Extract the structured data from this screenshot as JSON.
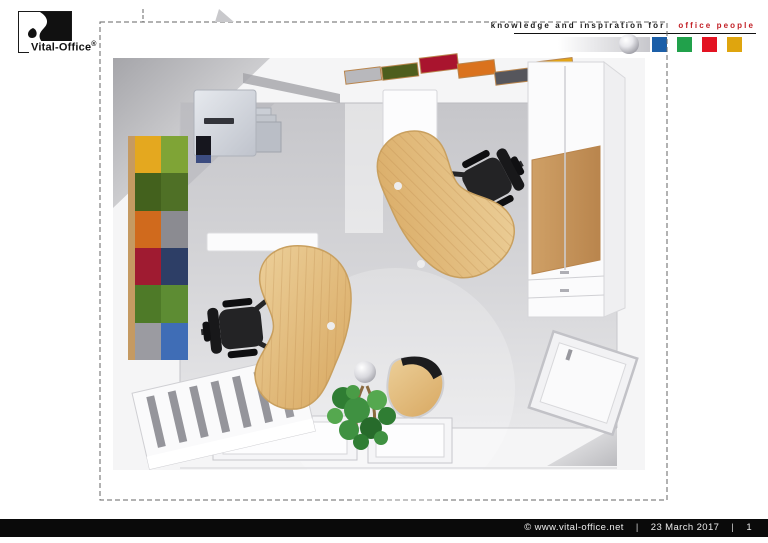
{
  "header": {
    "brand": "Vital-Office",
    "registered": "®",
    "tagline_black": "knowledge and inspiration for",
    "tagline_red": "office people",
    "tagline_red_color": "#c22026",
    "squares": [
      "#1c5fa8",
      "#21a14b",
      "#e31322",
      "#dfa50e"
    ]
  },
  "footer": {
    "copyright": "©  www.vital-office.net",
    "sep1": "|",
    "date": "23 March 2017",
    "sep2": "|",
    "page": "1"
  },
  "drawing": {
    "description": "3D top view rendering of an office room with two kidney-shaped beech desks, two black swivel chairs, colourful acoustic wall panel, ceiling panels, printer, tall cabinet, sideboard and plant",
    "floor_color": "#d2d2d5",
    "desk_wood_color": "#e0b872",
    "desk_edge_color": "#c9a05f",
    "chair_color": "#1c1c1e",
    "plant_color": "#3a8a3e",
    "panel_edge_color": "#c59a62",
    "ceiling_edge_color": "#b9854d",
    "wall_panel": {
      "cells": [
        "#e4a81f",
        "#7fa436",
        "#43611d",
        "#4f7026",
        "#d06a1d",
        "#8b8b91",
        "#9f1b31",
        "#2d3e66",
        "#4e7a28",
        "#5d8c33",
        "#9b9ba1",
        "#3f6db6"
      ]
    },
    "ceiling_panels": [
      "#b8b8bc",
      "#4e5e1d",
      "#a9142e",
      "#da721d",
      "#56565c",
      "#e3a416"
    ]
  }
}
